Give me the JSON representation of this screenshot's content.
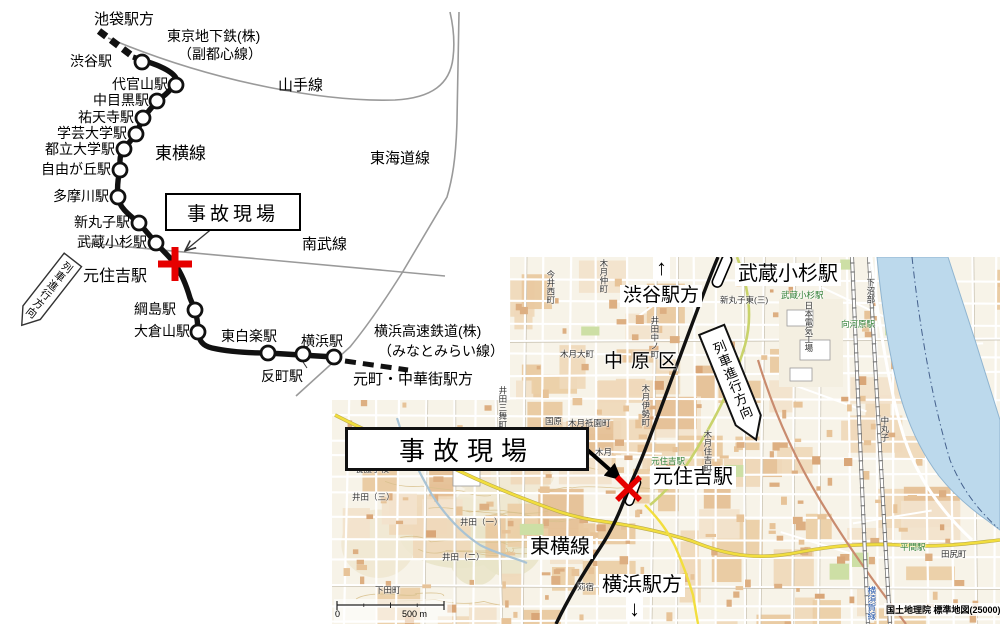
{
  "colors": {
    "accent_red": "#e60000",
    "rail_black": "#111111",
    "line_gray": "#9a9a9a",
    "map_base": "#f7f3e8",
    "river": "#bcd9ec",
    "river_edge": "#8fb4d0",
    "river_mid": "#44608c",
    "road_yellow": "#f2de3e",
    "road_ygreen": "#c9d36b",
    "road_brown": "#c98b6e",
    "green_text": "#2e7d32",
    "contour": "#d8c18e"
  },
  "schematic": {
    "banner": "列車進行方向",
    "accident_label": "事故現場",
    "stations": [
      {
        "name": "渋谷駅",
        "cx": 142,
        "cy": 62,
        "lr": 112,
        "ly": 54
      },
      {
        "name": "代官山駅",
        "cx": 176,
        "cy": 85,
        "lr": 168,
        "ly": 77
      },
      {
        "name": "中目黒駅",
        "cx": 157,
        "cy": 101,
        "lr": 149,
        "ly": 93
      },
      {
        "name": "祐天寺駅",
        "cx": 143,
        "cy": 118,
        "lr": 134,
        "ly": 110
      },
      {
        "name": "学芸大学駅",
        "cx": 136,
        "cy": 134,
        "lr": 127,
        "ly": 126
      },
      {
        "name": "都立大学駅",
        "cx": 124,
        "cy": 149,
        "lr": 115,
        "ly": 142
      },
      {
        "name": "自由が丘駅",
        "cx": 120,
        "cy": 170,
        "lr": 111,
        "ly": 162
      },
      {
        "name": "多摩川駅",
        "cx": 118,
        "cy": 197,
        "lr": 109,
        "ly": 189
      },
      {
        "name": "新丸子駅",
        "cx": 139,
        "cy": 223,
        "lr": 130,
        "ly": 215
      },
      {
        "name": "武蔵小杉駅",
        "cx": 156,
        "cy": 243,
        "lr": 147,
        "ly": 235
      },
      {
        "name": "綱島駅",
        "cx": 195,
        "cy": 310,
        "lr": 176,
        "ly": 302
      },
      {
        "name": "大倉山駅",
        "cx": 198,
        "cy": 332,
        "lr": 190,
        "ly": 324
      },
      {
        "name": "東白楽駅",
        "cx": 268,
        "cy": 353,
        "lx": 221,
        "ly": 329
      },
      {
        "name": "反町駅",
        "cx": 303,
        "cy": 354,
        "lx": 261,
        "ly": 369
      },
      {
        "name": "横浜駅",
        "cx": 334,
        "cy": 357,
        "lx": 301,
        "ly": 334
      }
    ],
    "labels": [
      {
        "id": "ikebukuro-direction",
        "text": "池袋駅方",
        "x": 94,
        "y": 12,
        "fs": 15
      },
      {
        "id": "tokyo-metro-line1",
        "text": "東京地下鉄(株)",
        "x": 167,
        "y": 29,
        "fs": 14
      },
      {
        "id": "tokyo-metro-line2",
        "text": "（副都心線）",
        "x": 178,
        "y": 47,
        "fs": 14
      },
      {
        "id": "yamanote-line",
        "text": "山手線",
        "x": 278,
        "y": 78,
        "fs": 15
      },
      {
        "id": "tokaido-line",
        "text": "東海道線",
        "x": 370,
        "y": 151,
        "fs": 15
      },
      {
        "id": "nambu-line",
        "text": "南武線",
        "x": 302,
        "y": 237,
        "fs": 15
      },
      {
        "id": "toyoko-line",
        "text": "東横線",
        "x": 155,
        "y": 144,
        "fs": 17
      },
      {
        "id": "motosumiyoshi-station",
        "text": "元住吉駅",
        "x": 83,
        "y": 268,
        "fs": 16
      },
      {
        "id": "minatomirai-line1",
        "text": "横浜高速鉄道(株)",
        "x": 374,
        "y": 324,
        "fs": 14
      },
      {
        "id": "minatomirai-line2",
        "text": "（みなとみらい線）",
        "x": 378,
        "y": 344,
        "fs": 14
      },
      {
        "id": "motomachi-direction",
        "text": "元町・中華街駅方",
        "x": 353,
        "y": 372,
        "fs": 15
      }
    ]
  },
  "map": {
    "banner": "列車進行方向",
    "accident_label": "事故現場",
    "labels": [
      {
        "id": "musashikosugi-station-label",
        "text": "武蔵小杉駅",
        "x": 735,
        "y": 263,
        "fs": 20,
        "bg": true
      },
      {
        "id": "shibuya-direction-arrow",
        "text": "↑",
        "x": 653,
        "y": 255,
        "fs": 22,
        "bg": true
      },
      {
        "id": "shibuya-direction",
        "text": "渋谷駅方",
        "x": 620,
        "y": 285,
        "fs": 19,
        "bg": true
      },
      {
        "id": "nakahara-ward",
        "text": "中原区",
        "x": 604,
        "y": 351,
        "fs": 19,
        "ls": 8,
        "bg": false
      },
      {
        "id": "motosumiyoshi-station-label",
        "text": "元住吉駅",
        "x": 650,
        "y": 466,
        "fs": 20,
        "bg": true
      },
      {
        "id": "toyoko-line-label",
        "text": "東横線",
        "x": 527,
        "y": 536,
        "fs": 20,
        "bg": true
      },
      {
        "id": "yokohama-direction",
        "text": "横浜駅方",
        "x": 599,
        "y": 574,
        "fs": 20,
        "bg": true
      },
      {
        "id": "yokohama-direction-arrow",
        "text": "↓",
        "x": 626,
        "y": 596,
        "fs": 22,
        "bg": true
      }
    ],
    "small_labels": [
      {
        "t": "今井西町",
        "x": 546,
        "y": 270,
        "v": true
      },
      {
        "t": "木月仲町",
        "x": 599,
        "y": 259,
        "v": true
      },
      {
        "t": "井田中ノ町",
        "x": 650,
        "y": 316,
        "v": true
      },
      {
        "t": "木月大町",
        "x": 560,
        "y": 350
      },
      {
        "t": "木月祗園町",
        "x": 568,
        "y": 419
      },
      {
        "t": "井田三舞町",
        "x": 498,
        "y": 386,
        "v": true
      },
      {
        "t": "木月伊勢町",
        "x": 641,
        "y": 384,
        "v": true
      },
      {
        "t": "木月",
        "x": 595,
        "y": 448
      },
      {
        "t": "木月住吉町",
        "x": 703,
        "y": 430,
        "v": true
      },
      {
        "t": "新丸子東(三)",
        "x": 720,
        "y": 296
      },
      {
        "t": "日本電気工場",
        "x": 804,
        "y": 301,
        "v": true
      },
      {
        "t": "下沼部",
        "x": 866,
        "y": 278,
        "v": true
      },
      {
        "t": "中丸子",
        "x": 880,
        "y": 416,
        "v": true
      },
      {
        "t": "向河原駅",
        "x": 841,
        "y": 320,
        "c": "#2e7d32"
      },
      {
        "t": "武蔵小杉駅",
        "x": 781,
        "y": 291,
        "c": "#2e7d32"
      },
      {
        "t": "元住吉駅",
        "x": 651,
        "y": 457,
        "c": "#2e7d32"
      },
      {
        "t": "平間駅",
        "x": 900,
        "y": 543,
        "c": "#2e7d32"
      },
      {
        "t": "田尻町",
        "x": 941,
        "y": 550
      },
      {
        "t": "養護学校",
        "x": 355,
        "y": 465
      },
      {
        "t": "井田（三）",
        "x": 352,
        "y": 493
      },
      {
        "t": "井田（一）",
        "x": 460,
        "y": 518
      },
      {
        "t": "井田（二）",
        "x": 442,
        "y": 553
      },
      {
        "t": "下田町",
        "x": 375,
        "y": 586
      },
      {
        "t": "苅宿",
        "x": 577,
        "y": 583
      },
      {
        "t": "国原",
        "x": 545,
        "y": 417
      },
      {
        "t": "横須賀線",
        "x": 867,
        "y": 586,
        "v": true,
        "c": "#2255aa"
      }
    ],
    "scale": {
      "start": "0",
      "end": "500 m"
    },
    "attribution": "国土地理院 標準地図(25000)"
  }
}
